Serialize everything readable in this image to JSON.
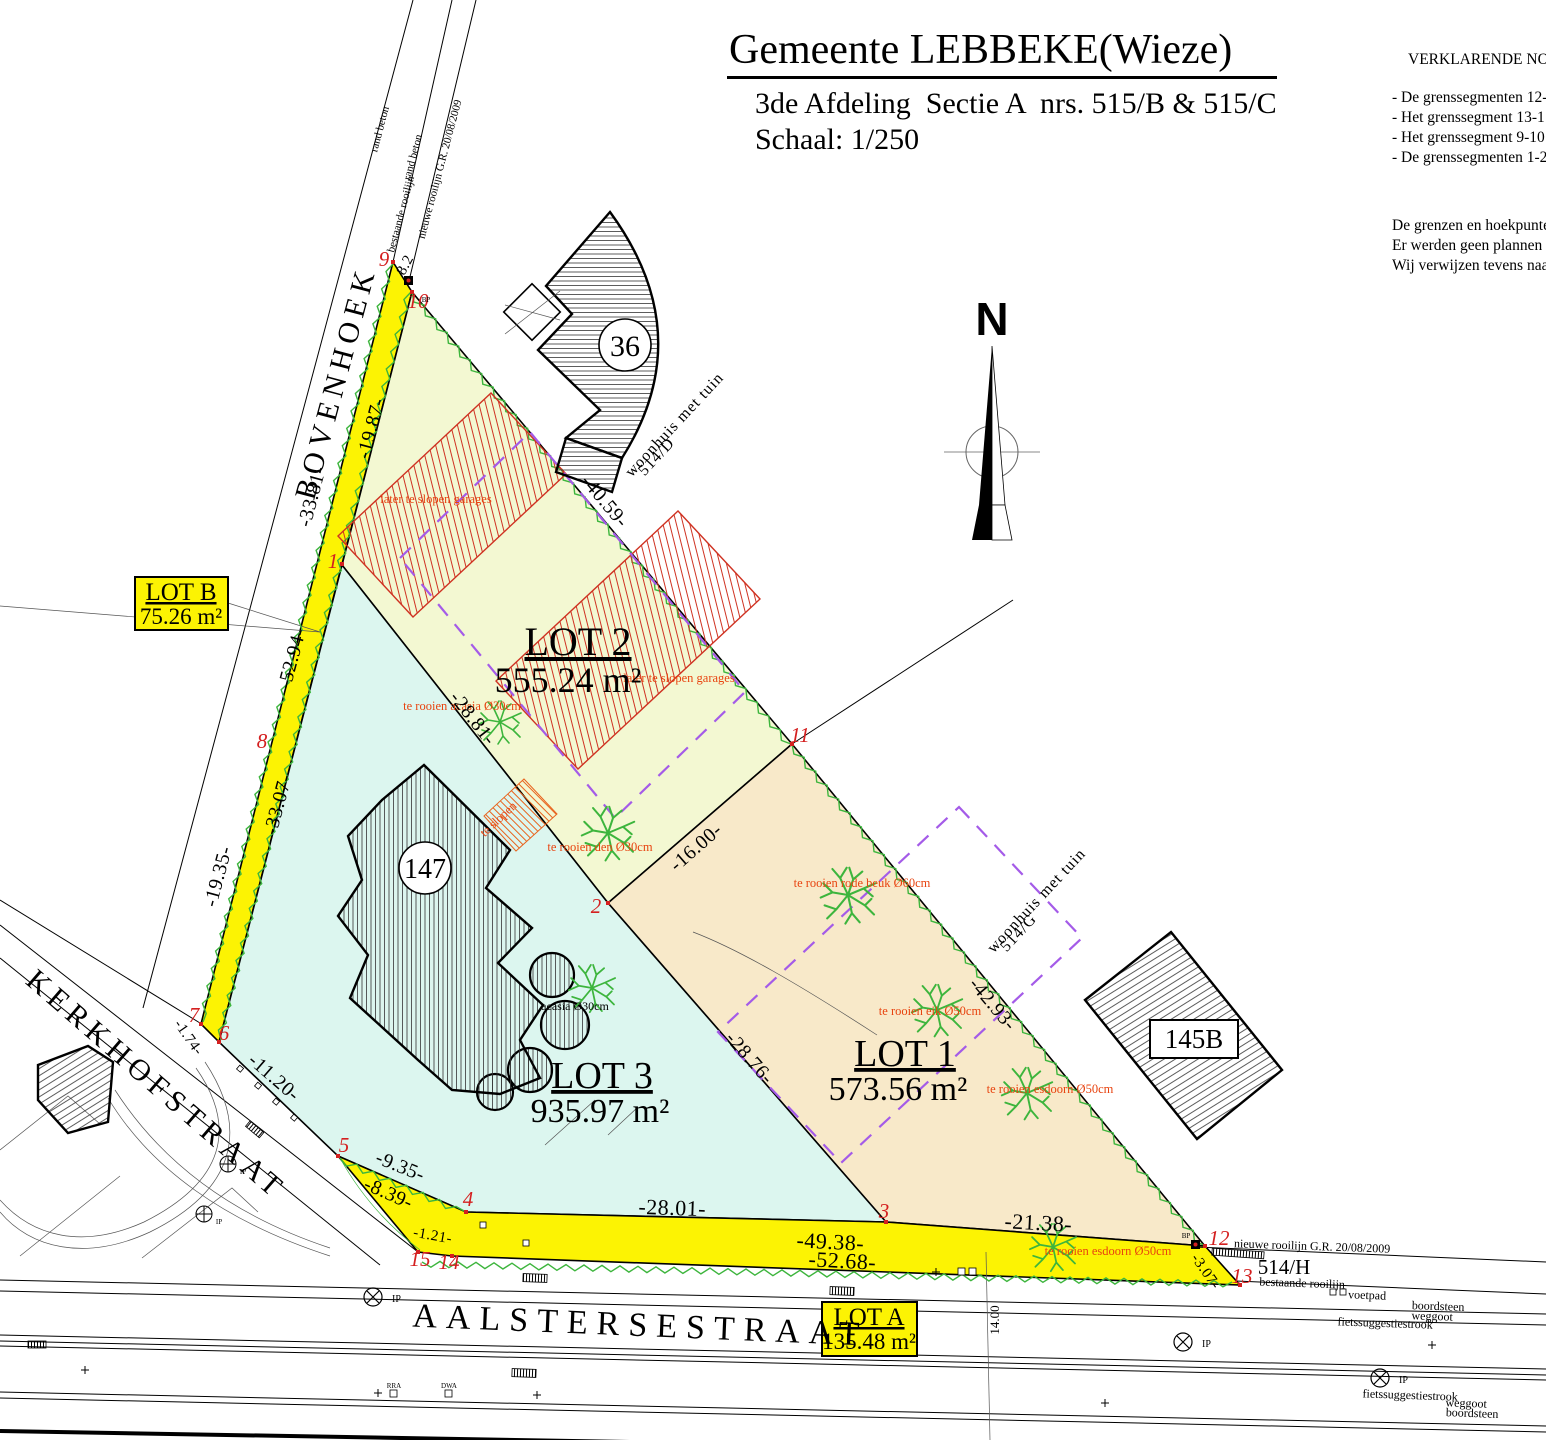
{
  "title": {
    "main": "Gemeente LEBBEKE(Wieze)",
    "line2": "3de Afdeling  Sectie A  nrs. 515/B & 515/C",
    "line3": "Schaal: 1/250"
  },
  "notes": {
    "heading": "VERKLARENDE NO",
    "bullets": [
      "- De grenssegmenten 12-",
      "- Het grenssegment 13-1",
      "- Het grenssegment 9-10",
      "- De grenssegmenten 1-2"
    ],
    "paragraph": [
      "De grenzen en hoekpunte",
      "Er werden geen plannen",
      "Wij verwijzen tevens naa"
    ]
  },
  "north_label": "N",
  "streets": {
    "bovenhoek": "BOVENHOEK",
    "kerkhofstraat": "KERKHOFSTRAAT",
    "aalstersestraat": "AALSTERSESTRAAT"
  },
  "lots": {
    "lot1": {
      "name": "LOT 1",
      "area": "573.56 m²"
    },
    "lot2": {
      "name": "LOT 2",
      "area": "555.24 m²"
    },
    "lot3": {
      "name": "LOT 3",
      "area": "935.97 m²"
    },
    "lota": {
      "name": "LOT A",
      "area": "135.48 m²"
    },
    "lotb": {
      "name": "LOT B",
      "area": "75.26 m²"
    }
  },
  "buildings": {
    "b36": "36",
    "b147": "147",
    "b145b": "145B"
  },
  "parcels": {
    "p514d_line1": "woonhuis met tuin",
    "p514d_line2": "514/D",
    "p514g_line1": "woonhuis met tuin",
    "p514g_line2": "514/G",
    "p514h": "514/H"
  },
  "dims": {
    "d1987": "-19.87-",
    "d3381": "-33.81-",
    "d5294": "-52.94-",
    "d3307": "-33.07-",
    "d1935": "-19.35-",
    "d82": "8.2",
    "d4059": "-40.59-",
    "d2881": "-28.81-",
    "d1600": "-16.00-",
    "d2876": "-28.76-",
    "d4293": "-42.93-",
    "d1120": "-11.20-",
    "d174": "-1.74-",
    "d935": "-9.35-",
    "d839": "-8.39-",
    "d121": "-1.21-",
    "d2801": "-28.01-",
    "d4938": "-49.38-",
    "d5268": "-52.68-",
    "d2138": "-21.38-",
    "d307": "-3.07-",
    "d1400": "14.00"
  },
  "points": {
    "p1": "1",
    "p2": "2",
    "p3": "3",
    "p4": "4",
    "p5": "5",
    "p6": "6",
    "p7": "7",
    "p8": "8",
    "p9": "9",
    "p10": "10",
    "p11": "11",
    "p12": "12",
    "p13": "13",
    "p14": "14",
    "p15": "15"
  },
  "annotations": {
    "garages1": "later te slopen garages",
    "garages2": "later te slopen garages",
    "acasia": "te rooien acasia Ø30cm",
    "den": "te rooien den Ø30cm",
    "beuk": "te rooien rode beuk Ø60cm",
    "eik": "te rooien eik Ø50cm",
    "esdoorn1": "te rooien esdoorn Ø50cm",
    "esdoorn2": "te rooien esdoorn Ø50cm",
    "teslopen": "te slopen",
    "acasia_black": "acasia Ø30cm"
  },
  "road_labels": {
    "rand_beton_1": "rand beton",
    "rand_beton_2": "rand beton",
    "bestaande_rooilijn_top": "bestaande rooilijn",
    "nieuwe_rooilijn_top": "nieuwe rooilijn G.R. 20/08/2009",
    "nieuwe_rooilijn_bottom": "nieuwe rooilijn G.R. 20/08/2009",
    "bestaande_rooilijn_bottom": "bestaande rooilijn",
    "voetpad": "voetpad",
    "boordsteen_1": "boordsteen",
    "weggoot_1": "weggoot",
    "fiets_1": "fietssuggestiestrook",
    "fiets_2": "fietssuggestiestrook",
    "weggoot_2": "weggoot",
    "boordsteen_2": "boordsteen",
    "ip": "IP",
    "bp": "BP",
    "rra": "RRA",
    "dwa": "DWA"
  },
  "colors": {
    "strip_yellow": "#fcf303",
    "lot1_fill": "#f8e9c9",
    "lot2_fill": "#f3f8d2",
    "lot3_fill": "#dcf6ef",
    "zigzag": "#3db53d",
    "annotation_red": "#e8430f",
    "point_red": "#d42020",
    "envelope_purple": "#a45be8",
    "garage_red": "#cf3222"
  }
}
